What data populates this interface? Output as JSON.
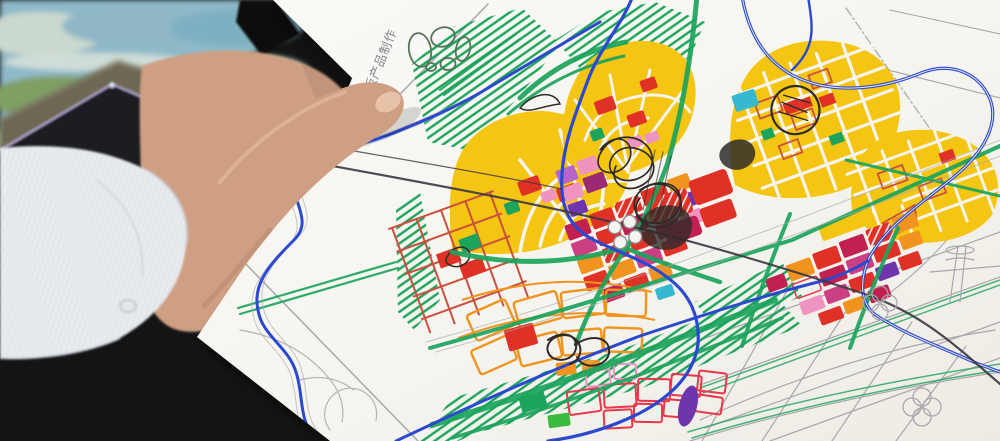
{
  "paper": {
    "watermark": "desk 教育版产品制作"
  },
  "palette": {
    "paper": "#f6f4ef",
    "deskSurface": "#141415",
    "photoWater": "#8fb9c8",
    "photoLand": "#74a168",
    "caseOlive": "#6d6852",
    "tabletBody": "#1b1a21",
    "tabletEdge": "#b3a5d4",
    "skin": "#cf9f83",
    "skinShadow": "#a87e63",
    "nail": "#e8c2a8",
    "sleeve": "#e9edf0",
    "sleeveStripe": "#d3dae1",
    "mapYellow": "#f5c513",
    "mapGreen": "#1ca45c",
    "mapRed": "#e03127",
    "mapCrimson": "#c32052",
    "mapMagenta": "#cb3f83",
    "mapPink": "#ef93c1",
    "mapViolet": "#b765c8",
    "mapPurple": "#6f35ad",
    "mapMulberry": "#9b2a72",
    "mapOrange": "#f0941f",
    "mapBlue": "#2b49cf",
    "mapCyan": "#35b8d0",
    "ink": "#2e2b28",
    "inkDark": "#3b3742",
    "pencil": "#a9a7ad",
    "redOutline": "#c9503c",
    "redBright": "#e8374a",
    "watermarkGray": "#85858c"
  }
}
